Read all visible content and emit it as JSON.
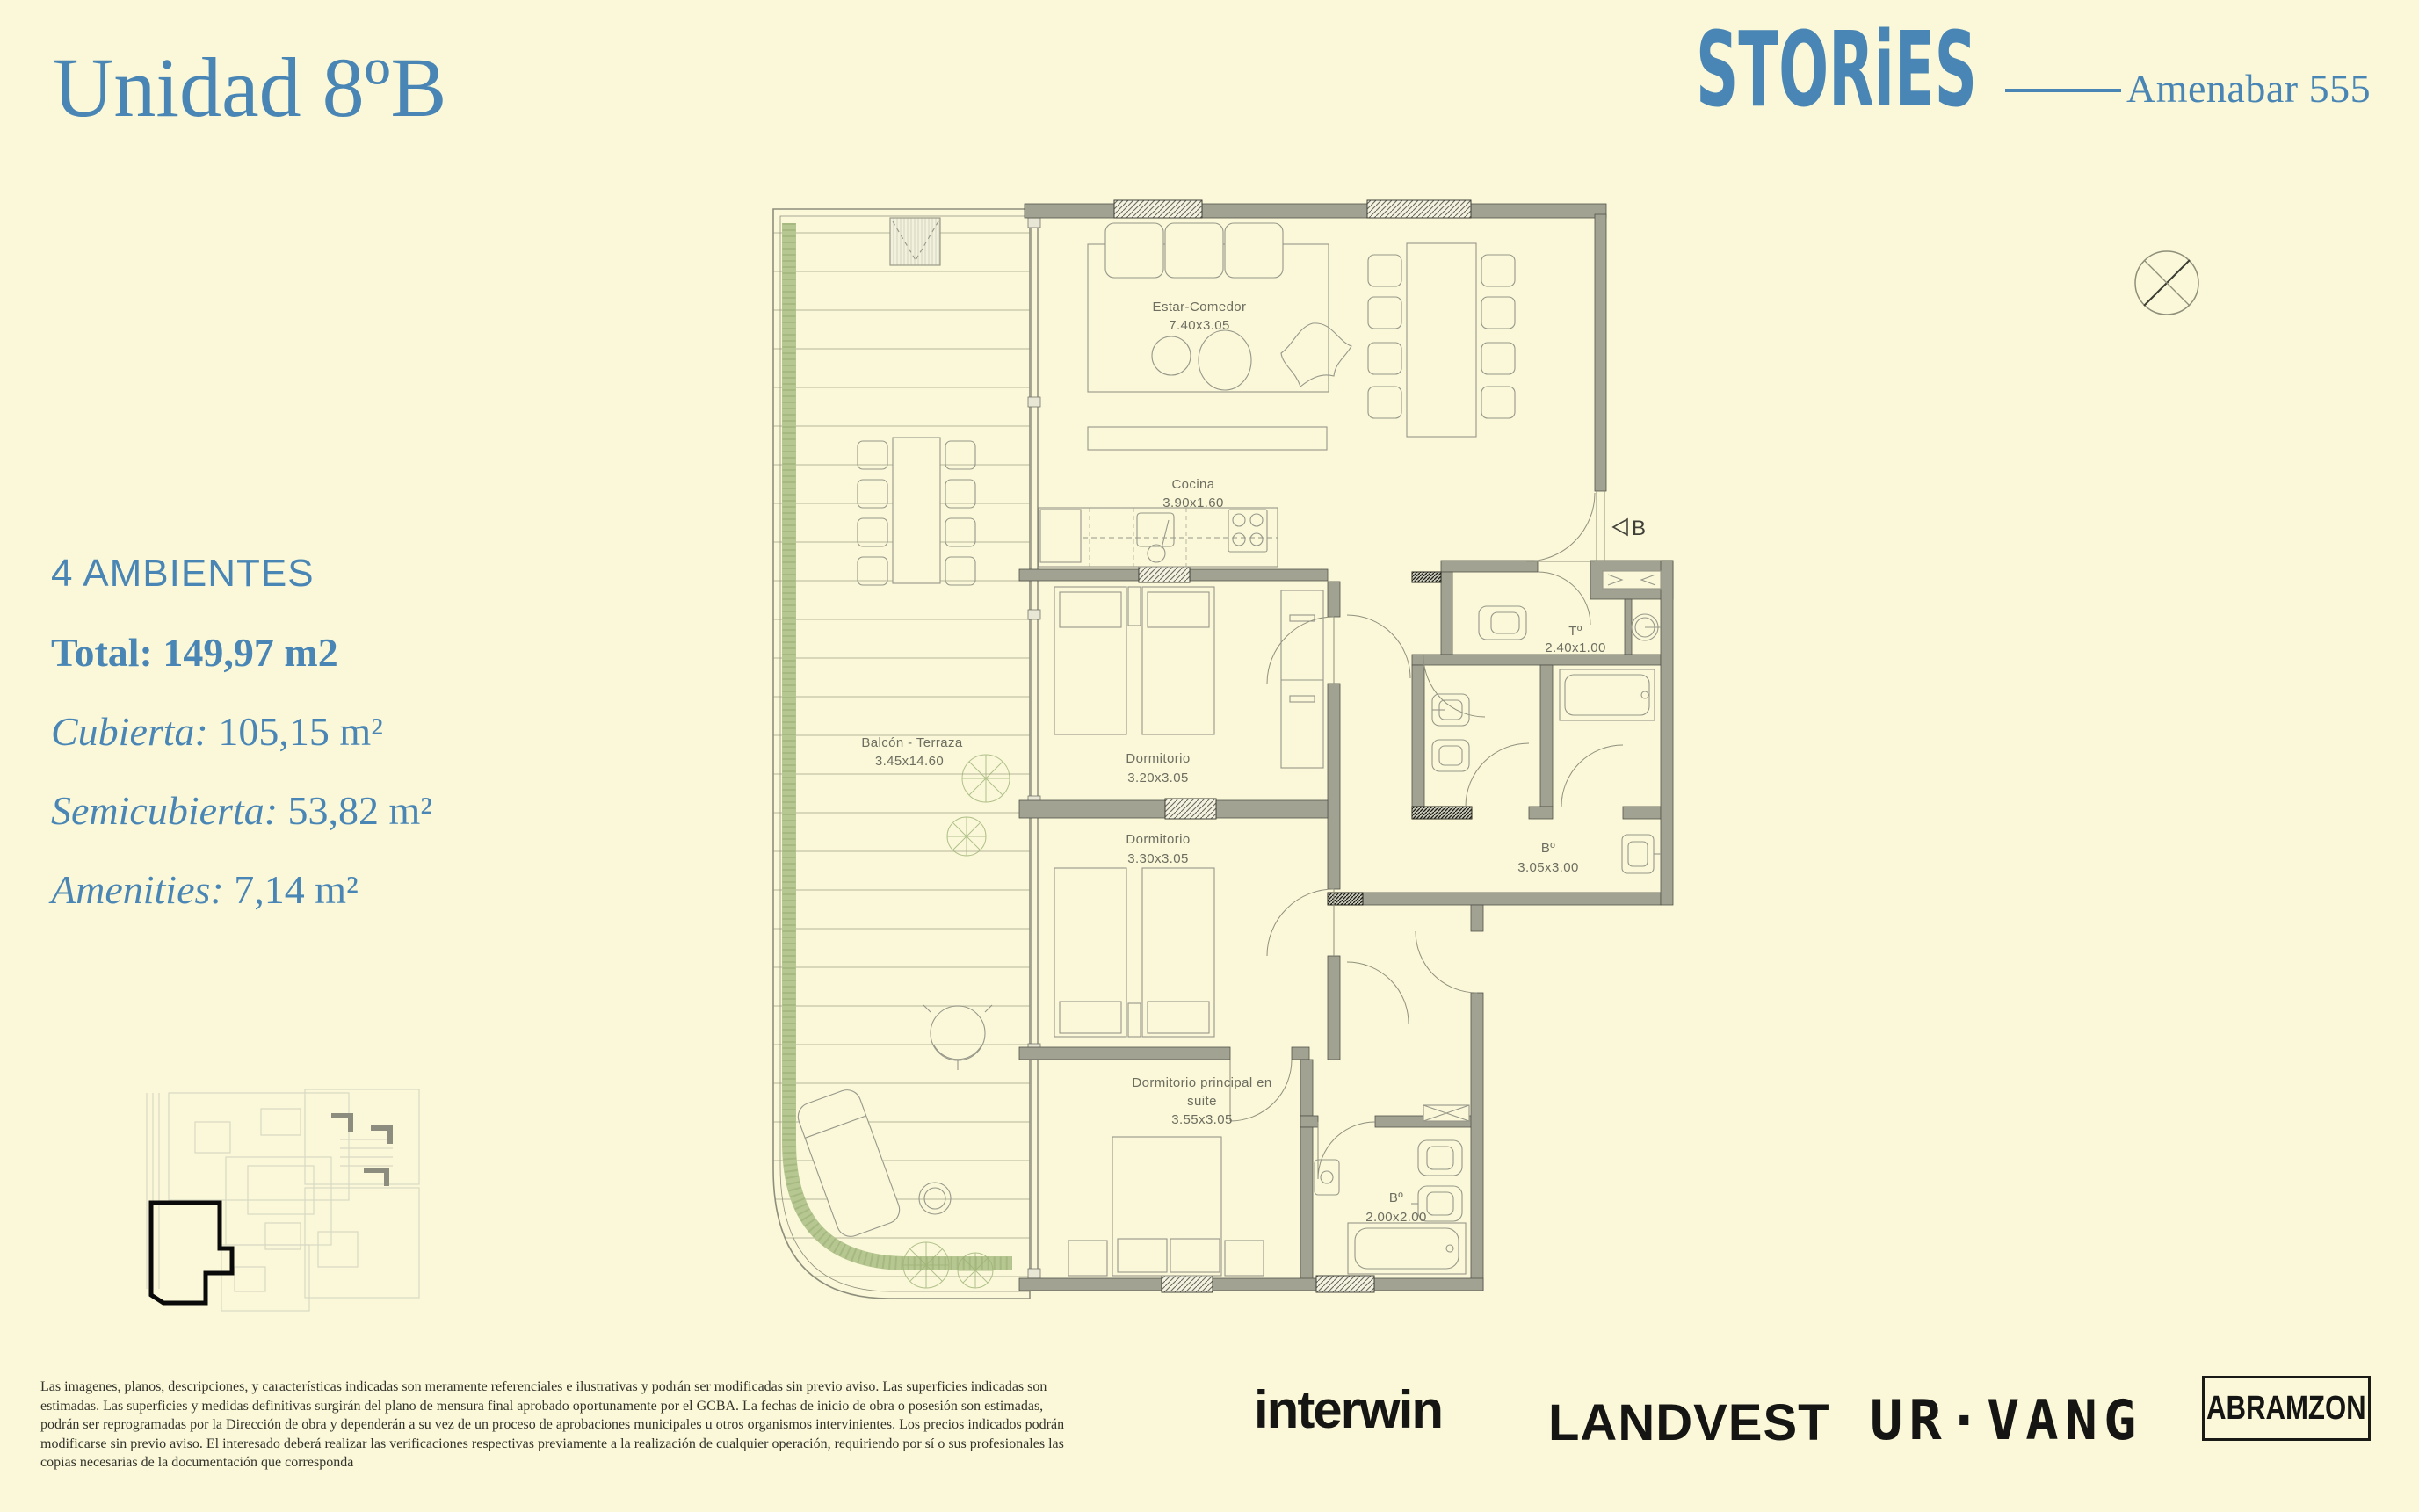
{
  "colors": {
    "background": "#FAF8D8",
    "accent_blue": "#4A86B5",
    "wall_gray": "#A2A292",
    "planter_green": "#B7C791",
    "logo_black": "#151513"
  },
  "header": {
    "unit_title": "Unidad 8ºB",
    "brand_logo": "STORiES",
    "project_name": "Amenabar 555"
  },
  "summary": {
    "rooms_count": "4 AMBIENTES",
    "total": {
      "label": "Total:",
      "value": "149,97 m2"
    },
    "areas": [
      {
        "label": "Cubierta:",
        "value": "105,15 m²"
      },
      {
        "label": "Semicubierta:",
        "value": "53,82 m²"
      },
      {
        "label": "Amenities:",
        "value": "7,14 m²"
      }
    ]
  },
  "floor_plan": {
    "entry_marker": "B",
    "rooms": {
      "living": {
        "name": "Estar-Comedor",
        "dims": "7.40x3.05"
      },
      "kitchen": {
        "name": "Cocina",
        "dims": "3.90x1.60"
      },
      "bedroom1": {
        "name": "Dormitorio",
        "dims": "3.20x3.05"
      },
      "bedroom2": {
        "name": "Dormitorio",
        "dims": "3.30x3.05"
      },
      "master_line1": "Dormitorio  principal  en",
      "master_line2": "suite",
      "master_dims": "3.55x3.05",
      "toilette": {
        "name": "Tº",
        "dims": "2.40x1.00"
      },
      "bathroom": {
        "name": "Bº",
        "dims": "3.05x3.00"
      },
      "ensuite_bath": {
        "name": "Bº",
        "dims": "2.00x2.00"
      },
      "balcony": {
        "name": "Balcón  -  Terraza",
        "dims": "3.45x14.60"
      }
    }
  },
  "disclaimer": "Las imagenes, planos, descripciones, y características  indicadas son meramente referenciales e ilustrativas y podrán ser modificadas  sin previo aviso. Las superficies indicadas son estimadas. Las superficies y medidas definitivas surgirán del plano de mensura final aprobado oportunamente por el GCBA. La fechas de inicio de obra o  posesión son estimadas, podrán ser reprogramadas por la Dirección de obra y dependerán a su vez de un proceso de aprobaciones municipales u otros organismos intervinientes. Los precios indicados podrán modificarse sin previo aviso. El interesado deberá realizar las verificaciones respectivas previamente a la realización de cualquier operación, requiriendo por sí o sus profesionales las copias necesarias de la documentación que corresponda",
  "footer": {
    "developers": [
      {
        "name": "interwin"
      },
      {
        "name": "LANDVEST"
      },
      {
        "name": "UR·VANG"
      },
      {
        "name": "ABRAMZON"
      }
    ]
  }
}
